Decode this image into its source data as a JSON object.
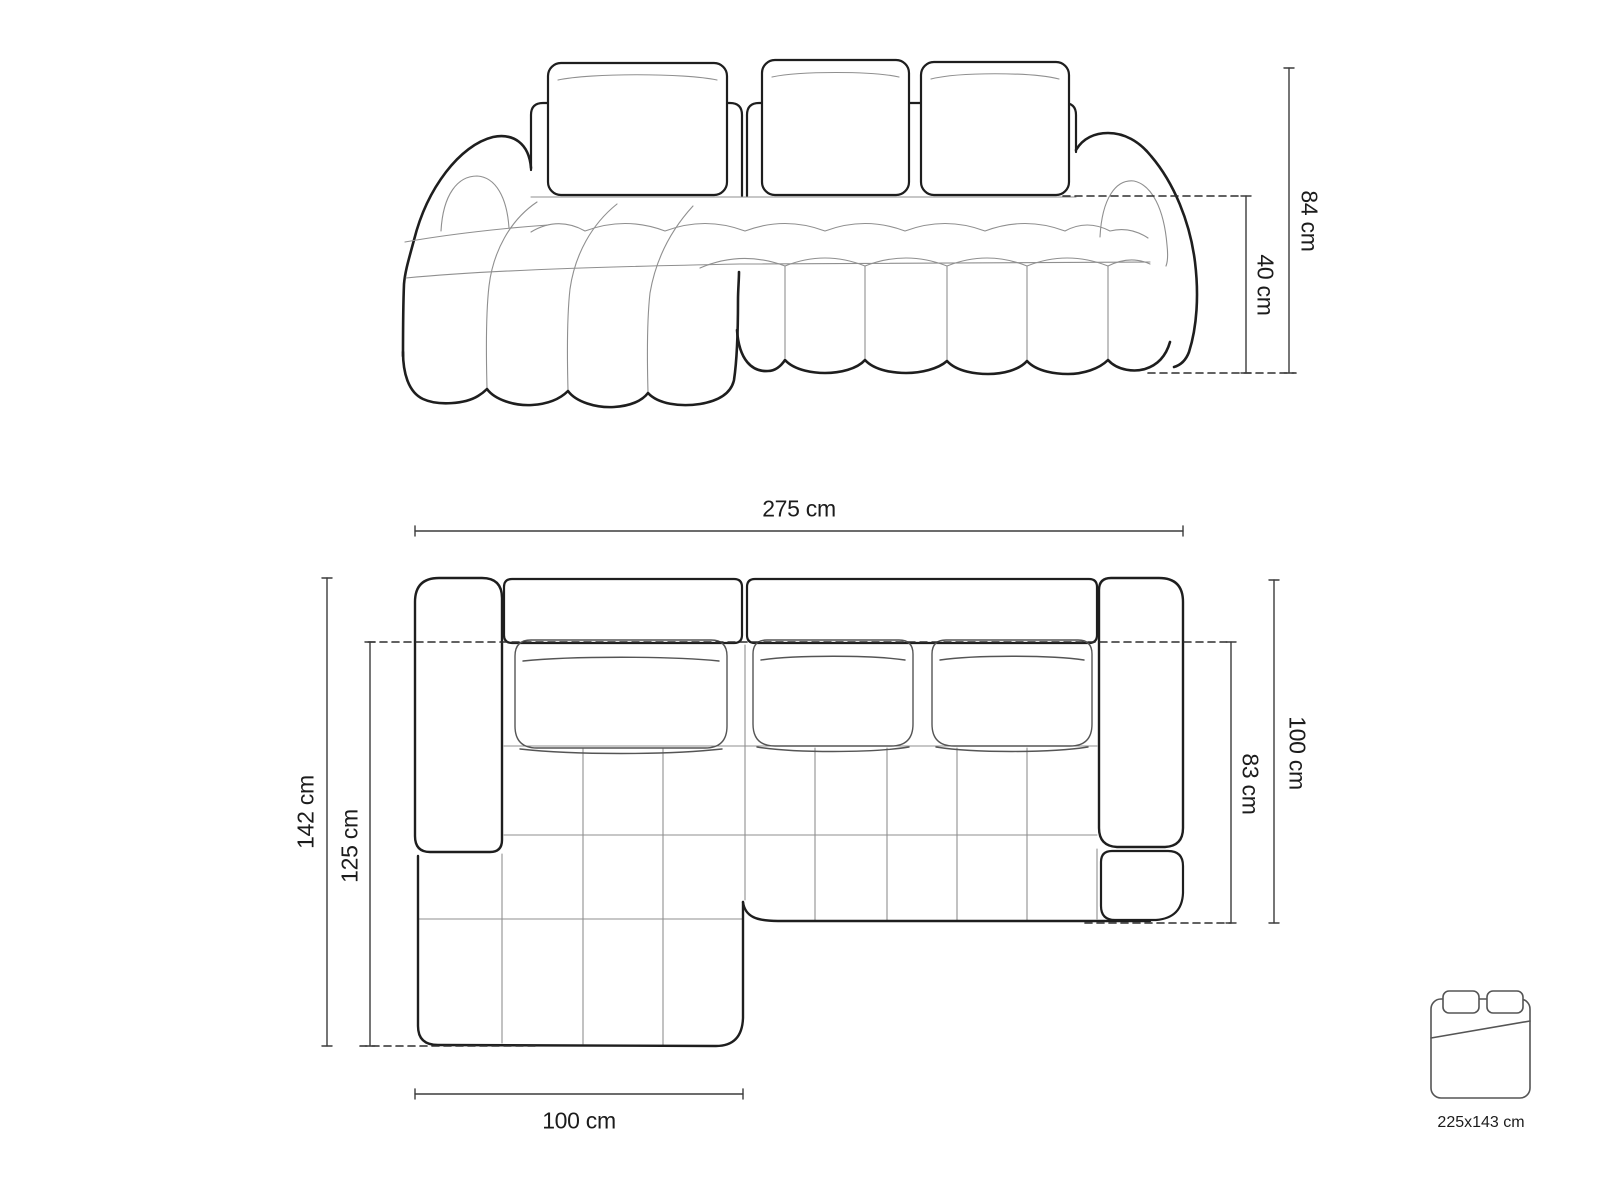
{
  "diagram_title": "corner-sofa-dimension-drawing",
  "front_view": {
    "overall_height": "84 cm",
    "seat_height": "40 cm"
  },
  "top_view": {
    "overall_width": "275 cm",
    "chaise_total_depth": "142 cm",
    "chaise_inner_depth": "125 cm",
    "body_total_depth": "100 cm",
    "body_inner_depth": "83 cm",
    "chaise_width": "100 cm"
  },
  "sleeping_area": {
    "size": "225x143 cm"
  },
  "colors": {
    "outline": "#1e1e1e",
    "detail_line": "#8f8f8f",
    "dimension_line": "#3c3c3c",
    "dashed_line": "#2e2e2e",
    "background": "#ffffff",
    "text": "#1c1c1c"
  }
}
